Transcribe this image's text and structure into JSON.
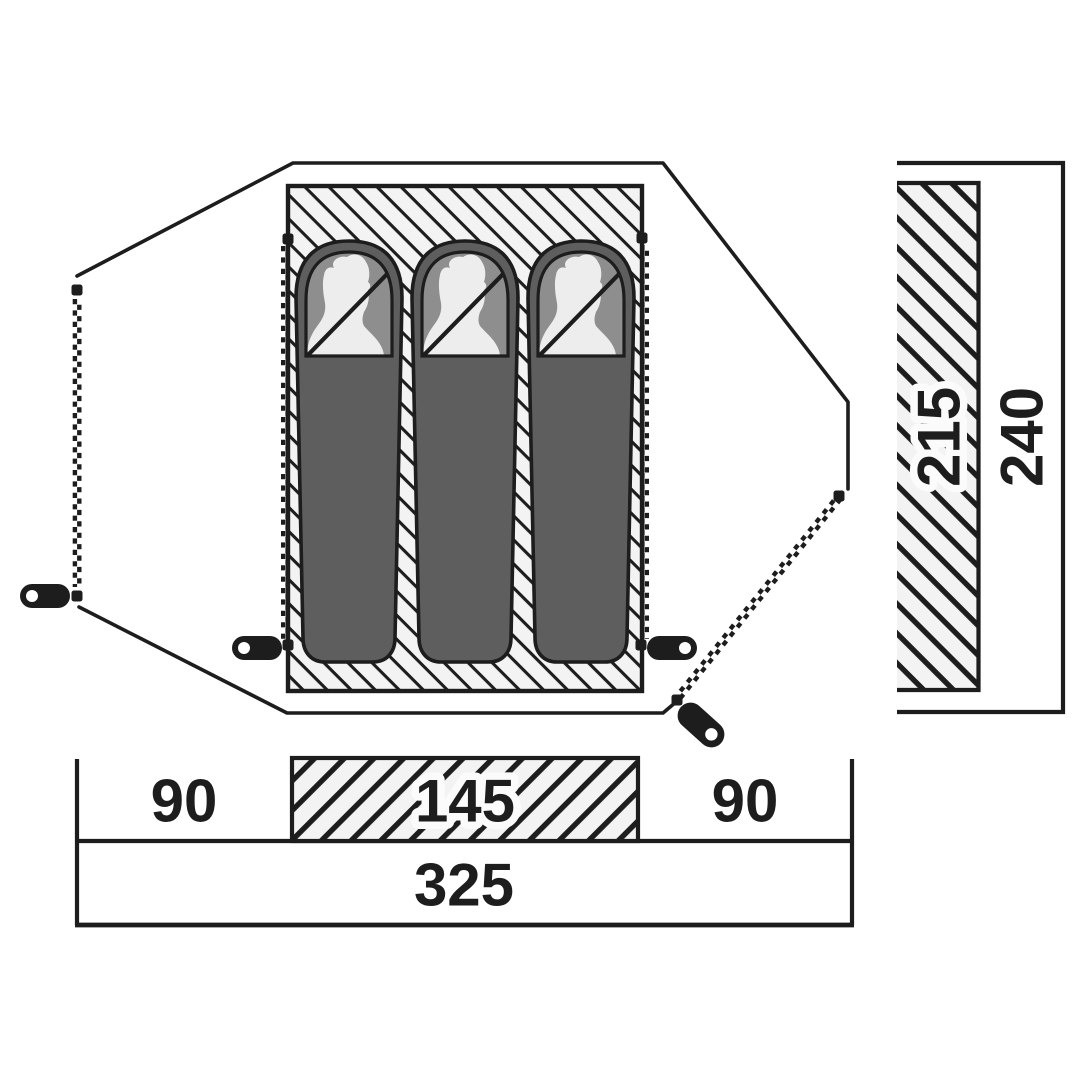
{
  "title": "Tent floor plan with dimensions",
  "dimensions": {
    "bottom": {
      "left": "90",
      "center": "145",
      "right": "90",
      "total": "325"
    },
    "side": {
      "inner": "215",
      "total": "240"
    }
  },
  "tent": {
    "sleeping_bag_count": 3,
    "door_zipper_count": 2,
    "inner_zipper_count": 2,
    "zipper_pull_count": 4
  },
  "colors": {
    "line": "#1d1d1d",
    "background": "#ffffff",
    "hatch_bg": "#f3f3f3",
    "bag_body": "#5e5e5e",
    "bag_hood": "#8e8e8e",
    "head": "#ededed",
    "halo": "#fbfbfb"
  }
}
